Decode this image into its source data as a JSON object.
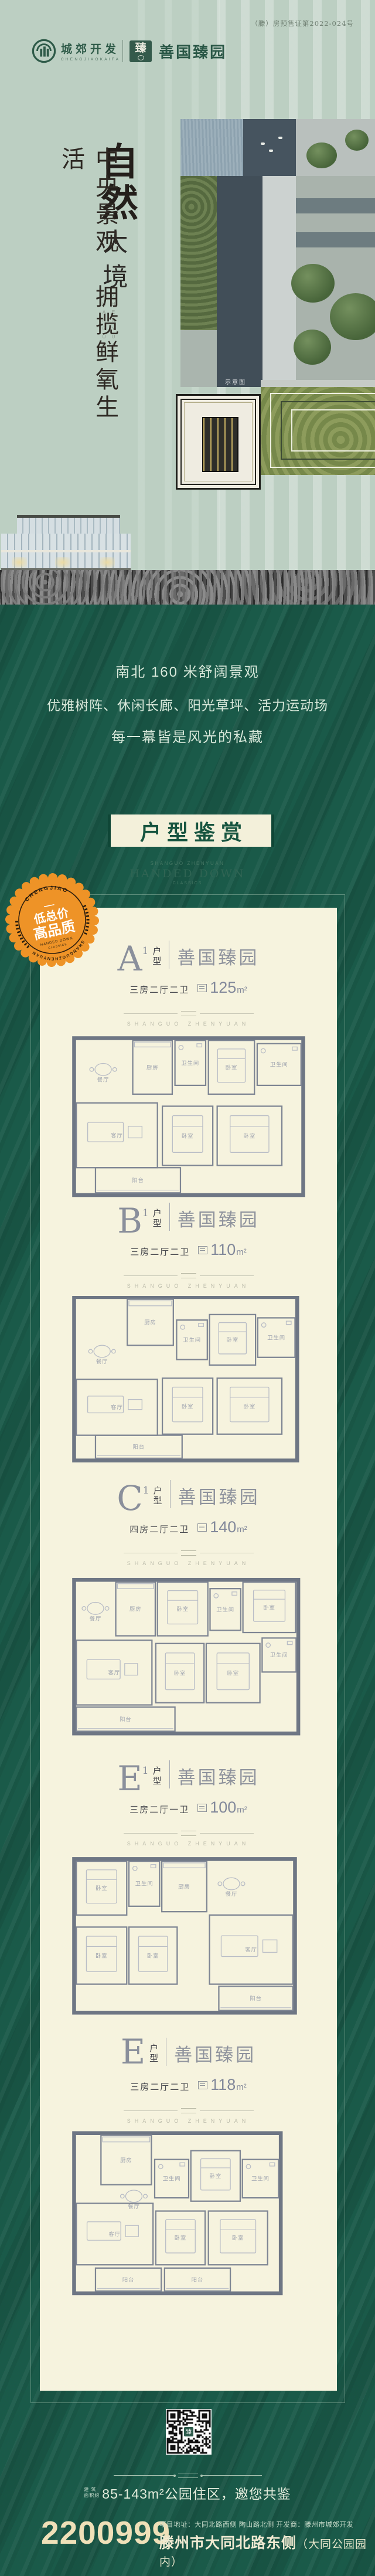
{
  "colors": {
    "deep_green": "#1a5a49",
    "sage": "#bccfc2",
    "cream_card": "#f6f3de",
    "badge_orange": "#ee9327",
    "phone_cream": "#efe0b8",
    "title_green": "#16543f"
  },
  "header": {
    "license": "（滕）房预售证第2022-024号",
    "brand": {
      "company": "城郊开发",
      "company_en": "CHENGJIAOKAIFA",
      "seal_char": "臻",
      "project": "善国臻园"
    },
    "headline": {
      "calligraphy": "自然",
      "subtitle": "大境",
      "vertical_en": [
        "SHANGUO",
        "ZHENYUAN"
      ],
      "slogan": "中央景观　拥揽鲜氧生活"
    },
    "photo_caption": "示意图"
  },
  "intro": {
    "lines": [
      "南北 160 米舒阔景观",
      "优雅树阵、休闲长廊、阳光草坪、活力运动场",
      "每一幕皆是风光的私藏"
    ]
  },
  "gallery": {
    "title": "户型鉴赏",
    "sub_small": "SHANGUO ZHENYUAN",
    "sub_main": "HANDED DOWN",
    "sub_tiny": "CLASSICS"
  },
  "badge": {
    "arc_top": "CHENGJIAO",
    "arc_bottom": "SHANGUOZHENYUAN",
    "line1": "低总价",
    "line2": "高品质",
    "tiny1": "HANDED DOWN",
    "tiny2": "CLASSICS"
  },
  "plans": {
    "label_hu": "户",
    "label_xing": "型",
    "brand": "善国臻园",
    "watermark": "SHANGUO ZHENYUAN",
    "items": [
      {
        "letter": "A",
        "sup": "1",
        "spec": "三房二厅二卫",
        "area": "125",
        "unit": "m²",
        "rooms": [
          [
            "餐厅",
            30,
            30,
            88,
            86,
            "open"
          ],
          [
            "厨房",
            128,
            12,
            72,
            98
          ],
          [
            "卫生间",
            205,
            12,
            56,
            82
          ],
          [
            "卧室",
            266,
            12,
            84,
            98
          ],
          [
            "卫生间",
            355,
            18,
            80,
            76
          ],
          [
            "客厅",
            25,
            126,
            148,
            118
          ],
          [
            "卧室",
            182,
            132,
            92,
            108
          ],
          [
            "卧室",
            282,
            132,
            118,
            108
          ],
          [
            "阳台",
            60,
            244,
            155,
            46
          ]
        ]
      },
      {
        "letter": "B",
        "sup": "1",
        "spec": "三房二厅二卫",
        "area": "110",
        "unit": "m²",
        "rooms": [
          [
            "厨房",
            118,
            6,
            84,
            84
          ],
          [
            "餐厅",
            30,
            70,
            84,
            78,
            "open"
          ],
          [
            "卫生间",
            208,
            44,
            56,
            72
          ],
          [
            "卧室",
            268,
            34,
            84,
            92
          ],
          [
            "卫生间",
            356,
            40,
            68,
            72
          ],
          [
            "客厅",
            25,
            152,
            148,
            102
          ],
          [
            "卧室",
            182,
            150,
            92,
            102
          ],
          [
            "卧室",
            282,
            150,
            118,
            102
          ],
          [
            "阳台",
            60,
            254,
            158,
            42
          ]
        ]
      },
      {
        "letter": "C",
        "sup": "1",
        "spec": "四房二厅二卫",
        "area": "140",
        "unit": "m²",
        "rooms": [
          [
            "餐厅",
            28,
            30,
            64,
            84,
            "open"
          ],
          [
            "厨房",
            97,
            16,
            72,
            98
          ],
          [
            "卧室",
            173,
            16,
            92,
            98
          ],
          [
            "卫生间",
            269,
            28,
            56,
            76
          ],
          [
            "卧室",
            329,
            16,
            96,
            92
          ],
          [
            "客厅",
            25,
            122,
            138,
            118
          ],
          [
            "卧室",
            170,
            128,
            88,
            108
          ],
          [
            "卧室",
            262,
            128,
            98,
            108
          ],
          [
            "卫生间",
            364,
            118,
            62,
            62
          ],
          [
            "阳台",
            25,
            244,
            180,
            44
          ]
        ]
      },
      {
        "letter": "E",
        "sup": "1",
        "spec": "三房二厅一卫",
        "area": "100",
        "unit": "m²",
        "rooms": [
          [
            "卧室",
            25,
            14,
            92,
            98
          ],
          [
            "卫生间",
            121,
            14,
            56,
            82
          ],
          [
            "厨房",
            181,
            14,
            82,
            92
          ],
          [
            "餐厅",
            267,
            22,
            82,
            82,
            "open"
          ],
          [
            "卧室",
            25,
            134,
            92,
            104
          ],
          [
            "卧室",
            121,
            134,
            88,
            104
          ],
          [
            "客厅",
            268,
            112,
            152,
            126
          ],
          [
            "阳台",
            285,
            242,
            135,
            44
          ]
        ]
      },
      {
        "letter": "E",
        "sup": "",
        "spec": "三房二厅二卫",
        "area": "118",
        "unit": "m²",
        "rooms": [
          [
            "厨房",
            70,
            8,
            92,
            90
          ],
          [
            "卫生间",
            168,
            52,
            62,
            70
          ],
          [
            "卧室",
            234,
            36,
            90,
            92
          ],
          [
            "卫生间",
            328,
            52,
            66,
            70
          ],
          [
            "餐厅",
            95,
            104,
            70,
            46,
            "open"
          ],
          [
            "客厅",
            25,
            132,
            140,
            112
          ],
          [
            "卧室",
            170,
            146,
            90,
            98
          ],
          [
            "卧室",
            266,
            146,
            108,
            98
          ],
          [
            "阳台",
            60,
            250,
            120,
            42
          ],
          [
            "阳台",
            186,
            250,
            120,
            42
          ]
        ]
      }
    ]
  },
  "footer": {
    "qr_char": "臻",
    "size_prefix": [
      "建 筑",
      "面积约"
    ],
    "size_text": "85-143m²公园住区，邀您共鉴",
    "phone": "2200999",
    "addr_small": "项目地址：大同北路西侧 陶山路北侧  开发商：滕州市城郊开发",
    "addr_big": "滕州市大同北路东侧",
    "addr_note": "（大同公园园内）"
  }
}
